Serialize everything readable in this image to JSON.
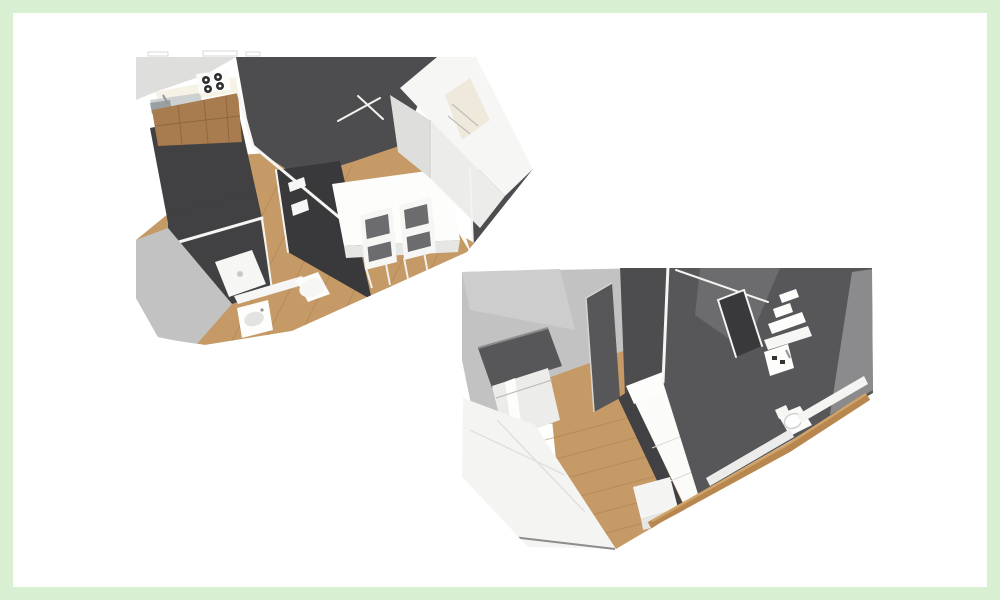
{
  "page": {
    "background": "#ffffff"
  },
  "frame": {
    "color": "#d8efd2",
    "width_px": 13
  },
  "palette": {
    "wall_dark": "#4d4d4f",
    "wall_mid": "#68686a",
    "wall_light": "#c2c2c3",
    "surface_white": "#f4f4f3",
    "surface_shaded": "#e2e2e0",
    "floor_wood": "#c59a66",
    "floor_wood_line": "#aa7f4f",
    "cabinet_wood": "#a87c4e",
    "fixture_white": "#fbfbfa"
  },
  "renders": [
    {
      "name": "apartment-3d-floor-plan-view-1",
      "x": 128,
      "y": 48,
      "width": 414,
      "height": 302
    },
    {
      "name": "apartment-3d-floor-plan-view-2",
      "x": 450,
      "y": 260,
      "width": 428,
      "height": 296
    }
  ]
}
